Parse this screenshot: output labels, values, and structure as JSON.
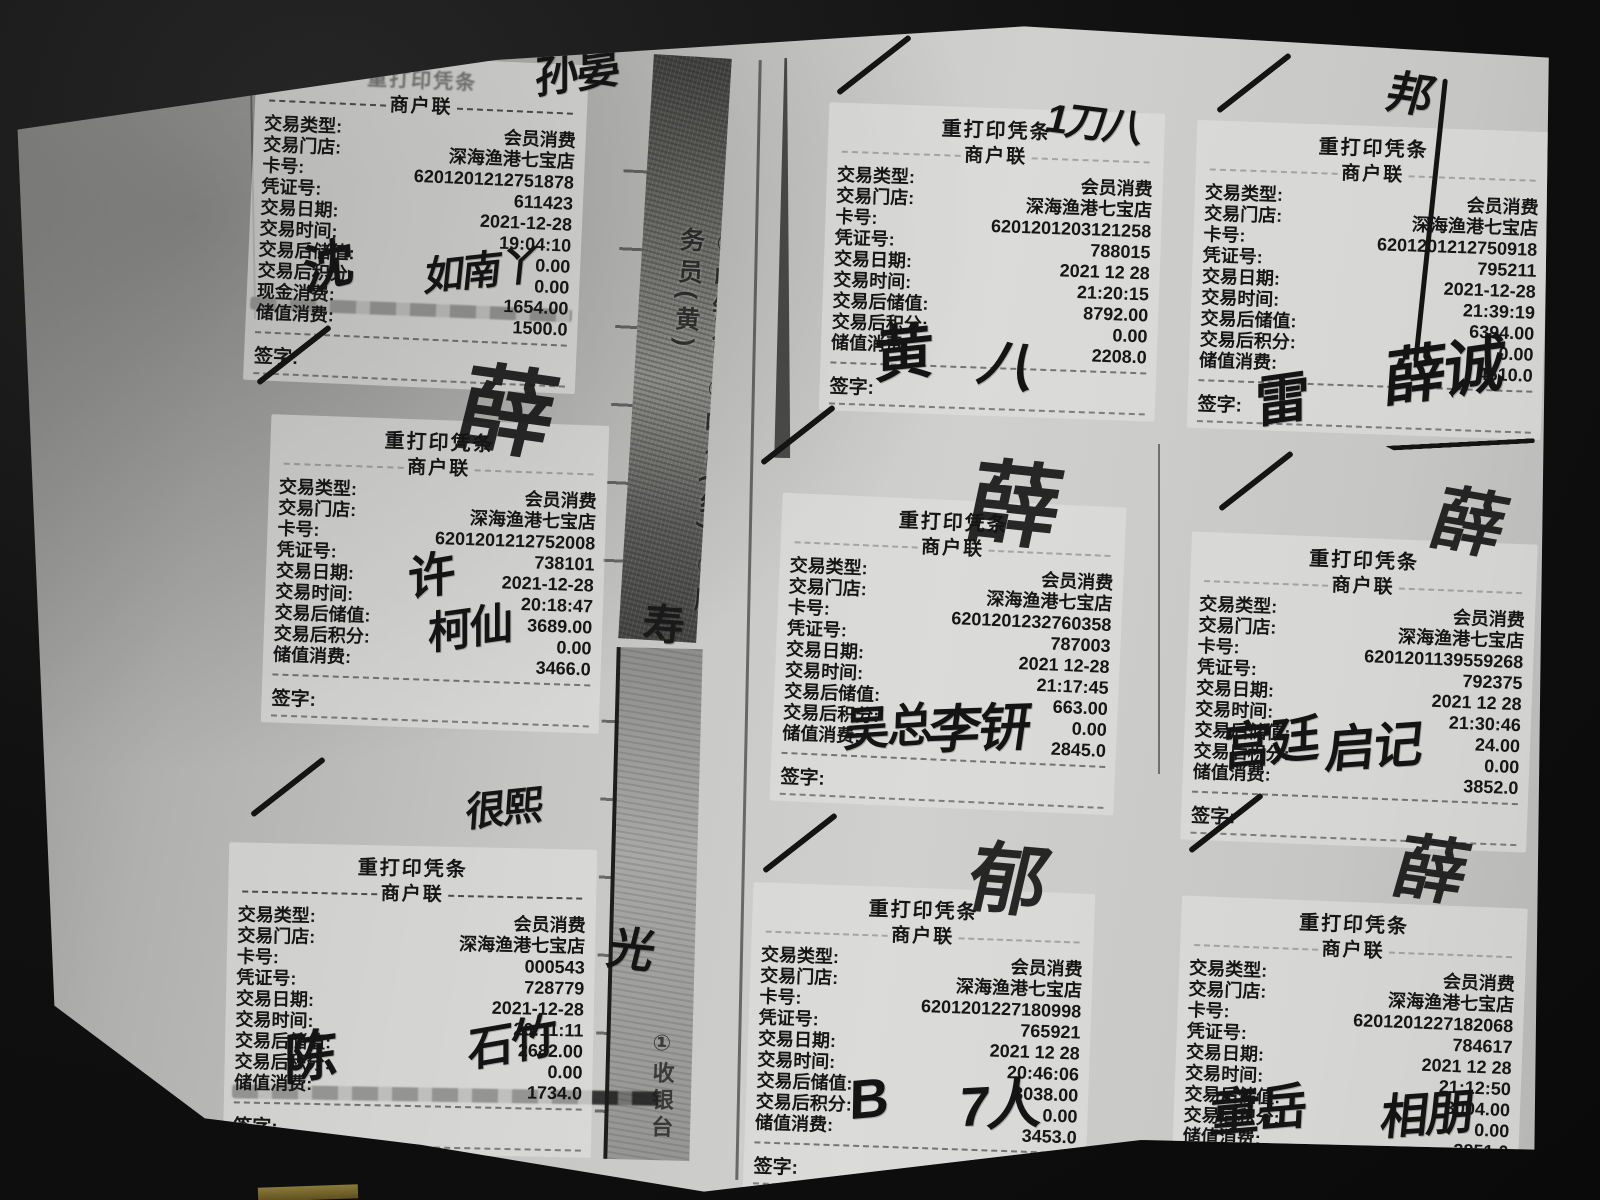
{
  "strips": {
    "strip1_text": "①收银台 ②吧台(红) ③服务员(黄)",
    "strip2_text": "①收银台"
  },
  "receipts": [
    {
      "title": "重打印凭条",
      "subtitle": "商户联",
      "sign_label": "签字:",
      "rows": [
        [
          "交易类型:",
          "会员消费"
        ],
        [
          "交易门店:",
          "深海渔港七宝店"
        ],
        [
          "卡号:",
          "6201201212751878"
        ],
        [
          "凭证号:",
          "611423"
        ],
        [
          "交易日期:",
          "2021-12-28"
        ],
        [
          "交易时间:",
          "19:04:10"
        ],
        [
          "交易后储值:",
          "0.00"
        ],
        [
          "交易后积分:",
          "0.00"
        ],
        [
          "现金消费:",
          "1654.00"
        ],
        [
          "储值消费:",
          "1500.0"
        ]
      ]
    },
    {
      "title": "重打印凭条",
      "subtitle": "商户联",
      "sign_label": "签字:",
      "rows": [
        [
          "交易类型:",
          "会员消费"
        ],
        [
          "交易门店:",
          "深海渔港七宝店"
        ],
        [
          "卡号:",
          "6201201212752008"
        ],
        [
          "凭证号:",
          "738101"
        ],
        [
          "交易日期:",
          "2021-12-28"
        ],
        [
          "交易时间:",
          "20:18:47"
        ],
        [
          "交易后储值:",
          "3689.00"
        ],
        [
          "交易后积分:",
          "0.00"
        ],
        [
          "储值消费:",
          "3466.0"
        ]
      ]
    },
    {
      "title": "重打印凭条",
      "subtitle": "商户联",
      "sign_label": "签字:",
      "rows": [
        [
          "交易类型:",
          "会员消费"
        ],
        [
          "交易门店:",
          "深海渔港七宝店"
        ],
        [
          "卡号:",
          "000543"
        ],
        [
          "凭证号:",
          "728779"
        ],
        [
          "交易日期:",
          "2021-12-28"
        ],
        [
          "交易时间:",
          "20:11:11"
        ],
        [
          "交易后储值:",
          "2682.00"
        ],
        [
          "交易后积分:",
          "0.00"
        ],
        [
          "储值消费:",
          "1734.0"
        ]
      ]
    },
    {
      "title": "重打印凭条",
      "subtitle": "商户联",
      "sign_label": "签字:",
      "rows": [
        [
          "交易类型:",
          "会员消费"
        ],
        [
          "交易门店:",
          "深海渔港七宝店"
        ],
        [
          "卡号:",
          "6201201203121258"
        ],
        [
          "凭证号:",
          "788015"
        ],
        [
          "交易日期:",
          "2021 12 28"
        ],
        [
          "交易时间:",
          "21:20:15"
        ],
        [
          "交易后储值:",
          "8792.00"
        ],
        [
          "交易后积分:",
          "0.00"
        ],
        [
          "储值消费:",
          "2208.0"
        ]
      ]
    },
    {
      "title": "重打印凭条",
      "subtitle": "商户联",
      "sign_label": "签字:",
      "rows": [
        [
          "交易类型:",
          "会员消费"
        ],
        [
          "交易门店:",
          "深海渔港七宝店"
        ],
        [
          "卡号:",
          "6201201232760358"
        ],
        [
          "凭证号:",
          "787003"
        ],
        [
          "交易日期:",
          "2021 12-28"
        ],
        [
          "交易时间:",
          "21:17:45"
        ],
        [
          "交易后储值:",
          "663.00"
        ],
        [
          "交易后积分:",
          "0.00"
        ],
        [
          "储值消费:",
          "2845.0"
        ]
      ]
    },
    {
      "title": "重打印凭条",
      "subtitle": "商户联",
      "sign_label": "签字:",
      "rows": [
        [
          "交易类型:",
          "会员消费"
        ],
        [
          "交易门店:",
          "深海渔港七宝店"
        ],
        [
          "卡号:",
          "6201201227180998"
        ],
        [
          "凭证号:",
          "765921"
        ],
        [
          "交易日期:",
          "2021 12 28"
        ],
        [
          "交易时间:",
          "20:46:06"
        ],
        [
          "交易后储值:",
          "3038.00"
        ],
        [
          "交易后积分:",
          "0.00"
        ],
        [
          "储值消费:",
          "3453.0"
        ]
      ]
    },
    {
      "title": "重打印凭条",
      "subtitle": "商户联",
      "sign_label": "签字:",
      "rows": [
        [
          "交易类型:",
          "会员消费"
        ],
        [
          "交易门店:",
          "深海渔港七宝店"
        ],
        [
          "卡号:",
          "6201201212750918"
        ],
        [
          "凭证号:",
          "795211"
        ],
        [
          "交易日期:",
          "2021-12-28"
        ],
        [
          "交易时间:",
          "21:39:19"
        ],
        [
          "交易后储值:",
          "6394.00"
        ],
        [
          "交易后积分:",
          "0.00"
        ],
        [
          "储值消费:",
          "4610.0"
        ]
      ]
    },
    {
      "title": "重打印凭条",
      "subtitle": "商户联",
      "sign_label": "签字:",
      "rows": [
        [
          "交易类型:",
          "会员消费"
        ],
        [
          "交易门店:",
          "深海渔港七宝店"
        ],
        [
          "卡号:",
          "6201201139559268"
        ],
        [
          "凭证号:",
          "792375"
        ],
        [
          "交易日期:",
          "2021 12 28"
        ],
        [
          "交易时间:",
          "21:30:46"
        ],
        [
          "交易后储值:",
          "24.00"
        ],
        [
          "交易后积分:",
          "0.00"
        ],
        [
          "储值消费:",
          "3852.0"
        ]
      ]
    },
    {
      "title": "重打印凭条",
      "subtitle": "商户联",
      "sign_label": "签字:",
      "rows": [
        [
          "交易类型:",
          "会员消费"
        ],
        [
          "交易门店:",
          "深海渔港七宝店"
        ],
        [
          "卡号:",
          "6201201227182068"
        ],
        [
          "凭证号:",
          "784617"
        ],
        [
          "交易日期:",
          "2021 12 28"
        ],
        [
          "交易时间:",
          "21:12:50"
        ],
        [
          "交易后储值:",
          "3004.00"
        ],
        [
          "交易后积分:",
          "0.00"
        ],
        [
          "储值消费:",
          "3851.0"
        ]
      ]
    }
  ],
  "annotations": [
    {
      "type": "sig",
      "text": "孙晏"
    },
    {
      "type": "sig",
      "text": "沈"
    },
    {
      "type": "sig",
      "text": "如南丫"
    },
    {
      "type": "slash"
    },
    {
      "type": "sig-big",
      "text": "薛"
    },
    {
      "type": "sig",
      "text": "许"
    },
    {
      "type": "sig",
      "text": "柯仙"
    },
    {
      "type": "slash"
    },
    {
      "type": "sig",
      "text": "很熙"
    },
    {
      "type": "sig",
      "text": "陈"
    },
    {
      "type": "sig",
      "text": "石竹"
    },
    {
      "type": "slash"
    },
    {
      "type": "sig",
      "text": "1刀八"
    },
    {
      "type": "sig",
      "text": "黄"
    },
    {
      "type": "sig",
      "text": "八"
    },
    {
      "type": "slash"
    },
    {
      "type": "sig-big",
      "text": "薛"
    },
    {
      "type": "sig",
      "text": "吴总"
    },
    {
      "type": "sig",
      "text": "李钘"
    },
    {
      "type": "slash"
    },
    {
      "type": "sig-big",
      "text": "郁"
    },
    {
      "type": "sig",
      "text": "B"
    },
    {
      "type": "sig",
      "text": "7人"
    },
    {
      "type": "slash"
    },
    {
      "type": "sig",
      "text": "邦"
    },
    {
      "type": "stroke-v"
    },
    {
      "type": "sig",
      "text": "雷"
    },
    {
      "type": "sig",
      "text": "薛诚"
    },
    {
      "type": "slash-long"
    },
    {
      "type": "slash"
    },
    {
      "type": "sig-big",
      "text": "薛"
    },
    {
      "type": "sig",
      "text": "宫廷"
    },
    {
      "type": "sig",
      "text": "启记"
    },
    {
      "type": "slash"
    },
    {
      "type": "sig-big",
      "text": "薛"
    },
    {
      "type": "sig",
      "text": "童岳"
    },
    {
      "type": "sig",
      "text": "相朋"
    },
    {
      "type": "sig",
      "text": "寿"
    },
    {
      "type": "sig",
      "text": "光"
    }
  ]
}
